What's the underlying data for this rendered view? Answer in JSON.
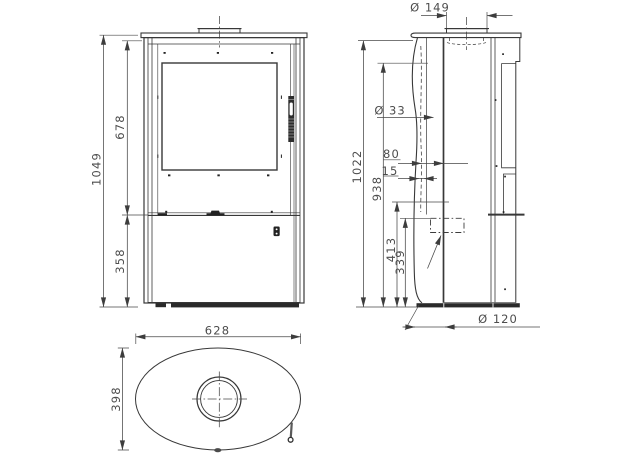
{
  "meta": {
    "title": "Stove technical drawing, three views with dimensions",
    "background": "#ffffff"
  },
  "colors": {
    "line": "#383838",
    "thick_line": "#1f1f1f",
    "dimension_line": "#474747",
    "text": "#4d4d4d"
  },
  "views": {
    "front": {
      "label": "front-view",
      "dims": {
        "total_height": "1049",
        "upper_section": "678",
        "lower_section": "358"
      }
    },
    "side": {
      "label": "side-view",
      "dims": {
        "flue_diameter": "Ø 149",
        "rear_outlet_diameter": "Ø 33",
        "top_offset": "80",
        "gap": "15",
        "total_height": "1022",
        "rear_outlet_height": "938",
        "mid_height": "413",
        "intake_height": "339",
        "floor_intake_diameter": "Ø 120"
      }
    },
    "top": {
      "label": "top-view",
      "dims": {
        "width": "628",
        "depth": "398"
      }
    }
  }
}
